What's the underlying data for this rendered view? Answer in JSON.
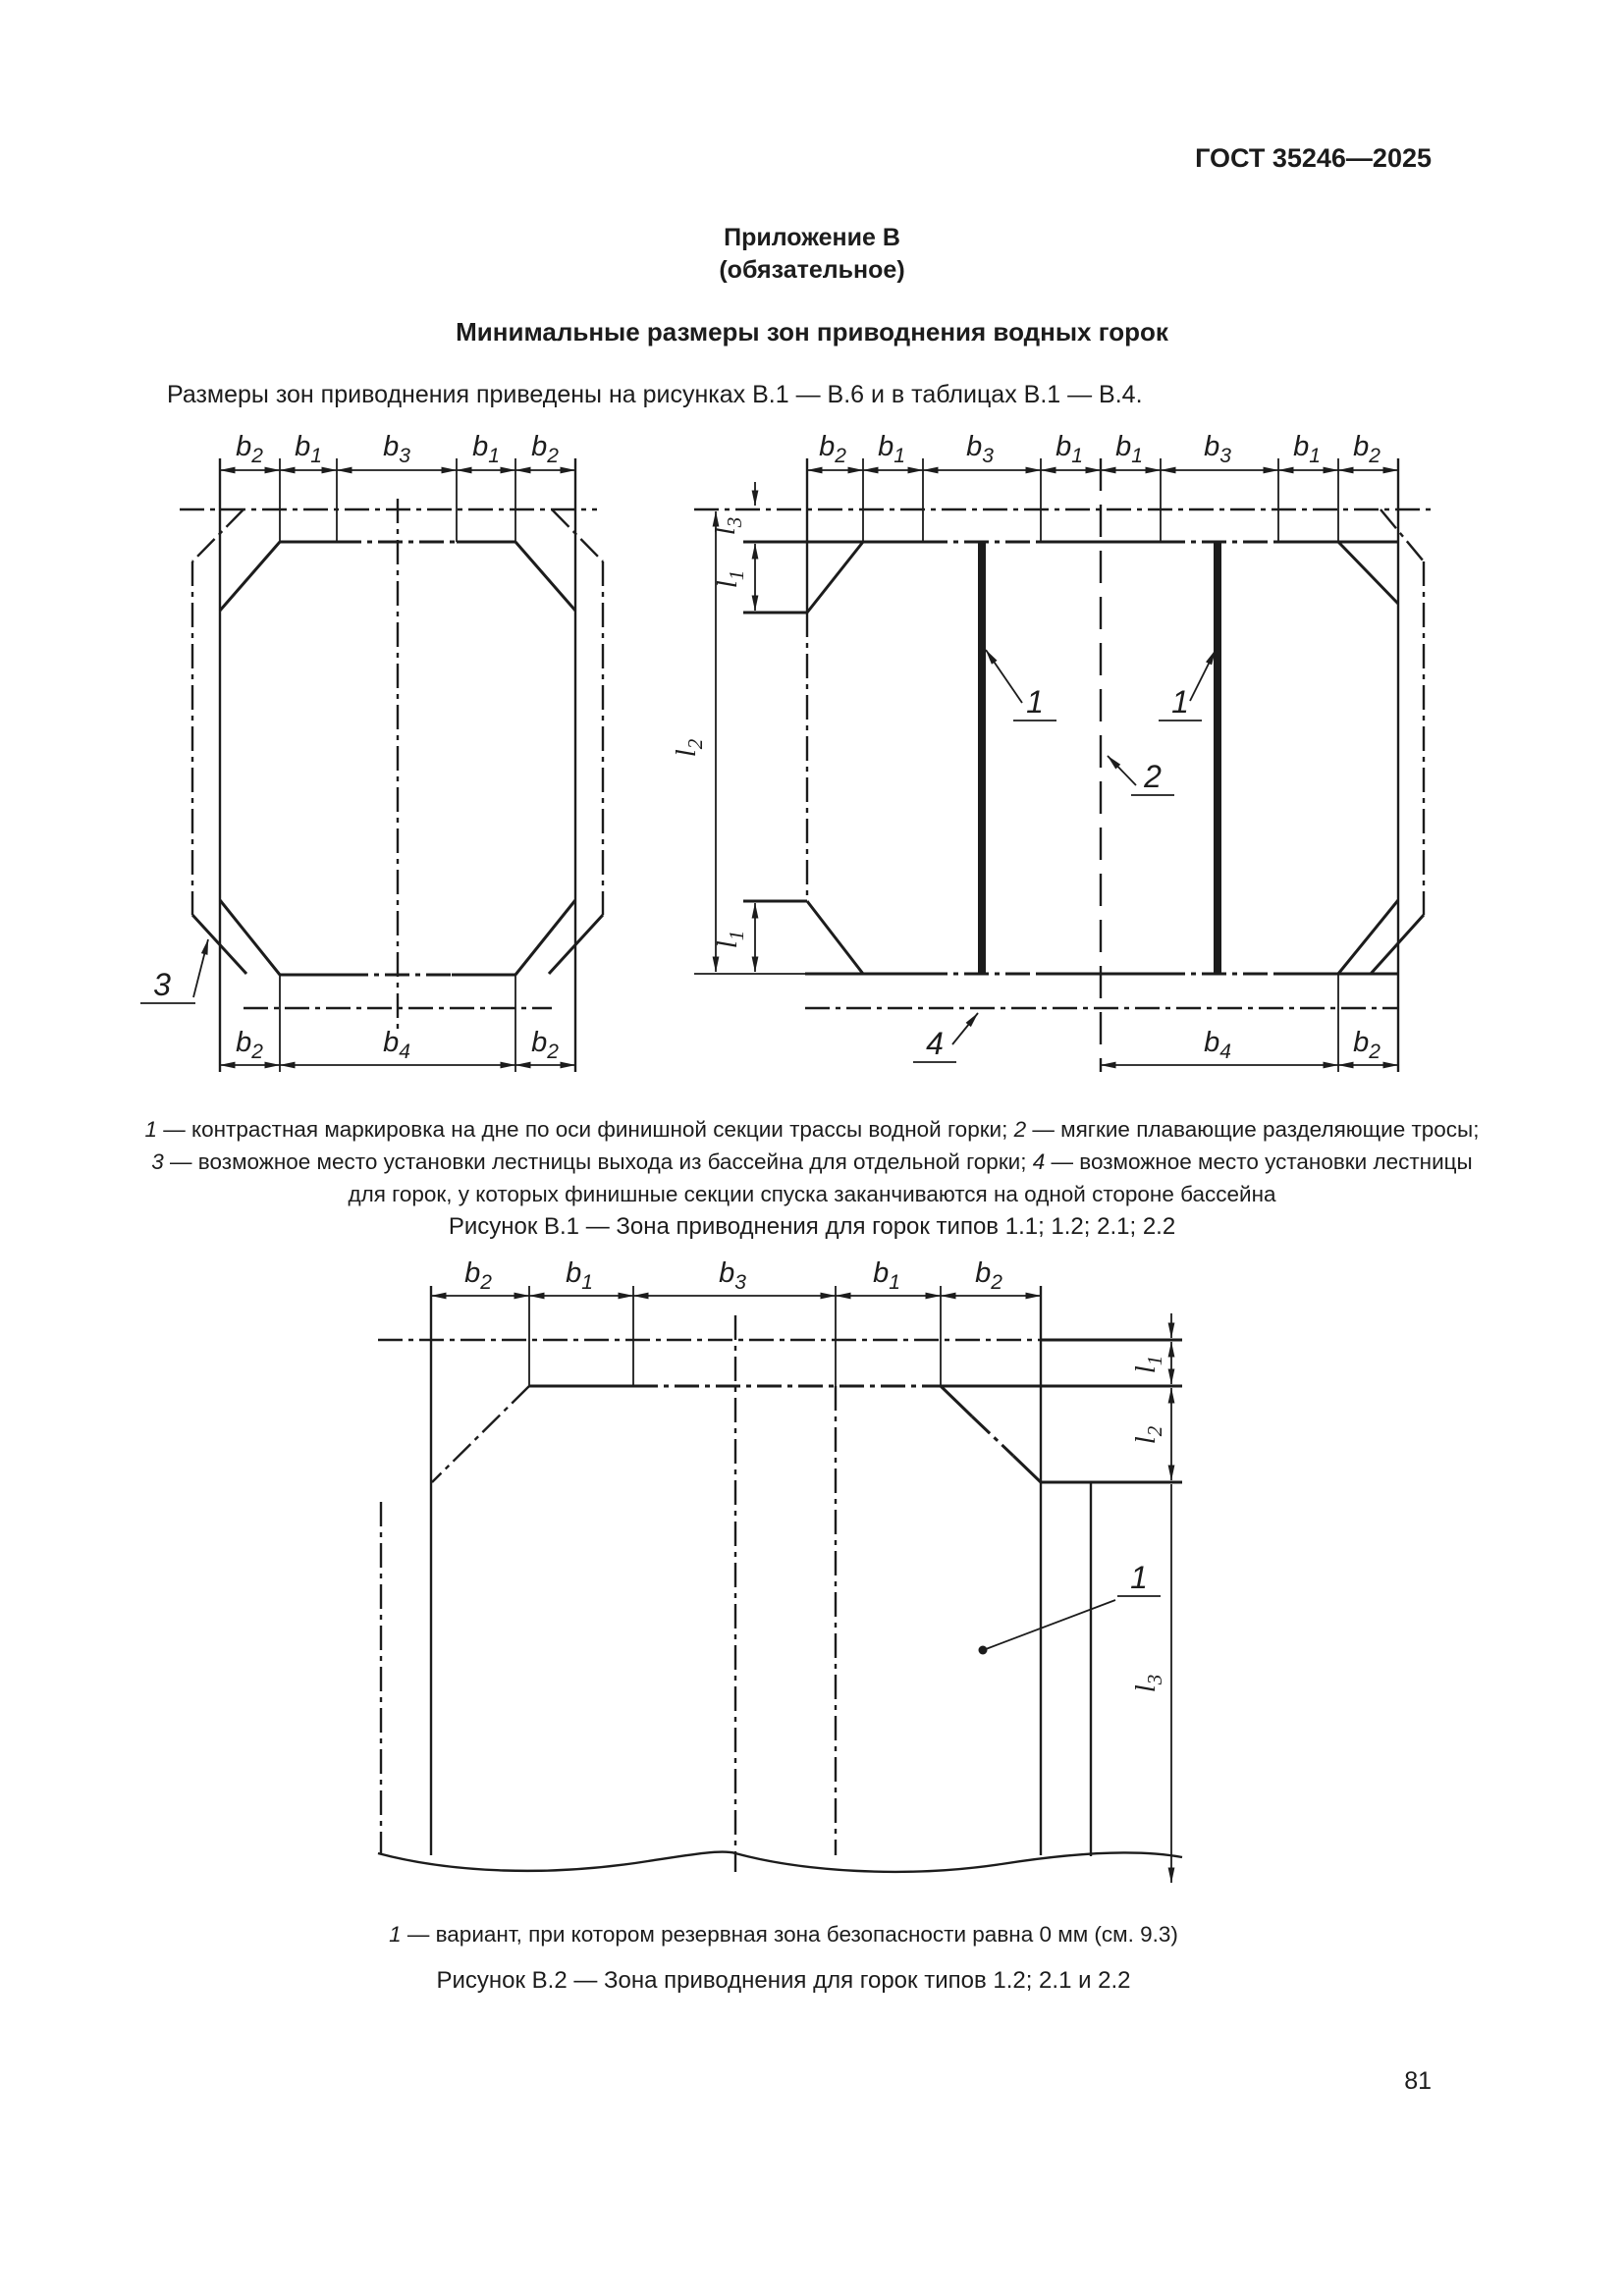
{
  "page": {
    "header": "ГОСТ 35246—2025",
    "page_number": "81"
  },
  "appendix": {
    "label": "Приложение В",
    "type": "(обязательное)",
    "title": "Минимальные размеры зон приводнения водных горок",
    "intro": "Размеры зон приводнения приведены на рисунках В.1 — В.6 и в таблицах В.1 — В.4."
  },
  "dims": {
    "b1": {
      "base": "b",
      "sub": "1"
    },
    "b2": {
      "base": "b",
      "sub": "2"
    },
    "b3": {
      "base": "b",
      "sub": "3"
    },
    "b4": {
      "base": "b",
      "sub": "4"
    },
    "l1": {
      "base": "l",
      "sub": "1"
    },
    "l2": {
      "base": "l",
      "sub": "2"
    },
    "l3": {
      "base": "l",
      "sub": "3"
    }
  },
  "callouts": {
    "c1": "1",
    "c2": "2",
    "c3": "3",
    "c4": "4"
  },
  "figure1": {
    "caption": "Рисунок В.1 — Зона приводнения для горок типов 1.1; 1.2; 2.1; 2.2",
    "legend": {
      "seg1": "1",
      "seg2": " — контрастная маркировка на дне по оси финишной секции трассы водной горки; ",
      "seg3": "2",
      "seg4": " — мягкие плавающие разделяющие тросы;",
      "seg5": "3",
      "seg6": " — возможное место установки лестницы выхода из бассейна для отдельной горки; ",
      "seg7": "4",
      "seg8": " — возможное место установки лестницы",
      "seg9": "для горок, у которых финишные секции спуска заканчиваются на одной стороне бассейна"
    }
  },
  "figure2": {
    "caption": "Рисунок В.2 — Зона приводнения для горок типов 1.2; 2.1 и 2.2",
    "legend": {
      "seg1": "1",
      "seg2": " — вариант, при котором резервная зона безопасности равна 0 мм (см. 9.3)"
    }
  }
}
